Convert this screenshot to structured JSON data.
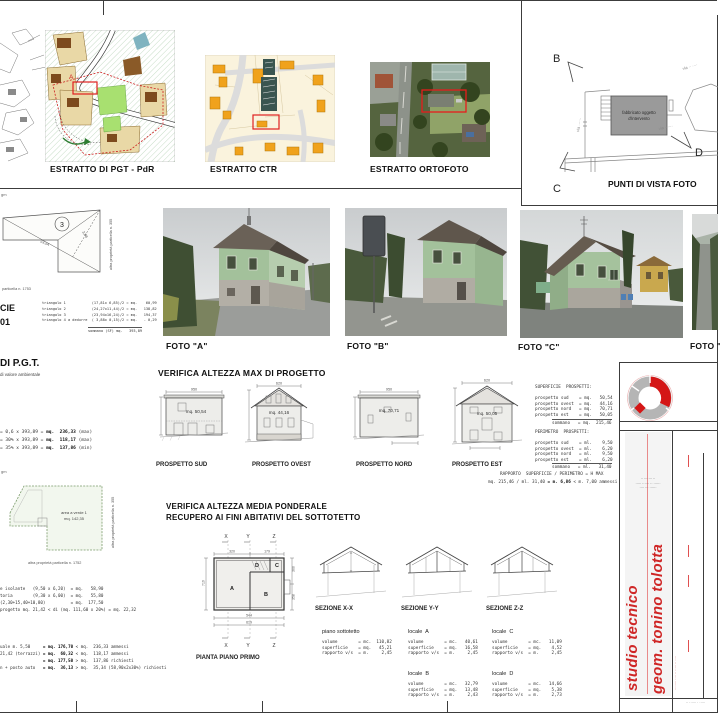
{
  "maps": {
    "pgt_label": "ESTRATTO DI PGT - PdR",
    "pgt_marker": "A",
    "ctr_label": "ESTRATTO CTR",
    "orto_label": "ESTRATTO ORTOFOTO"
  },
  "viewpoints": {
    "title": "PUNTI DI VISTA FOTO",
    "b": "B",
    "c": "C",
    "d": "D",
    "building_line1": "fabbricato oggetto",
    "building_line2": "d'intervento",
    "street_left": "via ······",
    "street_top": "via ·· ····",
    "street_d": "via ······"
  },
  "photos": {
    "a": "FOTO \"A\"",
    "b": "FOTO \"B\"",
    "c": "FOTO \"C\"",
    "d": "FOTO \"D\""
  },
  "survey": {
    "frag_top": "gm",
    "frag_mid": "gm",
    "parcel_no": "3",
    "dim_diag": "23,94",
    "dim_diag2": "3,88",
    "note_right": "altra proprietà particella n. 355",
    "note_bottom": "particella n. 1753",
    "heading_frag1": "CIE",
    "heading_frag2": "01",
    "triangles": "triangolo 1            (17,81x 6,85)/2 = mq.    60,99\ntriangolo 2            (24,27x11,44)/2 = mq.   138,82\ntriangolo 3            (23,94x16,24)/2 = mq.   194,37\ntriangolo 4 a dedurre  ( 3,88x 0,15)/2 = mq.   - 0,29",
    "triangles_total": "sommano (SF) mq.   393,89",
    "pgt_heading": "DI P.G.T.",
    "pgt_sub": "di valore ambientale",
    "pgt_rows": [
      {
        "calc": "= 0,6 x 393,89 =",
        "value": "mq.  236,33",
        "note": "(max)"
      },
      {
        "calc": "= 30% x 393,89 =",
        "value": "mq.  118,17",
        "note": "(max)"
      },
      {
        "calc": "= 35% x 393,89 =",
        "value": "mq.  137,86",
        "note": "(min)"
      }
    ],
    "verde_line1": "area a verde 1",
    "verde_line2": "mq. 142,35",
    "note_right2": "altra proprietà particella n. 355",
    "note_bottom2": "altra proprietà particella n. 1752",
    "calcs": "e isolante   (9,50 x 6,20)  = mq.   58,90\ntoria        (9,30 x 6,00)  = mq.   55,80\n(2,30+15,40+10,80)          = mq.  177,50\nprogetto mq. 21,42 < di (mq. 111,60 x 20%) = mq. 22,32",
    "summary_rows": [
      {
        "lead": "uale m. 5,50     ",
        "value": "= mq. 176,70",
        "rest": " < mq.  236,33 ammessi"
      },
      {
        "lead": "21,42 (terrazzi) ",
        "value": "= mq.  60,32",
        "rest": " < mq.  118,17 ammessi"
      },
      {
        "lead": "                 ",
        "value": "= mq. 177,50",
        "rest": " > mq.  137,86 richiesti"
      },
      {
        "lead": "n + posto auto   ",
        "value": "= mq.  36,13",
        "rest": " > mq.  35,34 (58,90x2x30%) richiesti"
      }
    ]
  },
  "verifica_max": {
    "title": "VERIFICA ALTEZZA MAX DI PROGETTO",
    "prospetti": [
      {
        "label": "PROSPETTO SUD",
        "area": "mq. 50,54",
        "dim": "950"
      },
      {
        "label": "PROSPETTO OVEST",
        "area": "mq. 44,16",
        "dim": "620"
      },
      {
        "label": "PROSPETTO NORD",
        "area": "mq. 70,71",
        "dim": "950"
      },
      {
        "label": "PROSPETTO EST",
        "area": "mq. 50,05",
        "dim": "620"
      }
    ],
    "sup_table": "SUPERFICIE  PROSPETTI:\n\nprospetto sud    = mq.   50,54\nprospetto ovest  = mq.   44,16\nprospetto nord   = mq.   70,71\nprospetto est    = mq.   50,05",
    "sup_total": "sommano   = mq.  215,46",
    "per_table": "PERIMETRO  PROSPETTI:\n\nprospetto sud    = ml.    9,50\nprospetto ovest  = ml.    6,20\nprospetto nord   = ml.    9,50\nprospetto est    = ml.    6,20",
    "per_total": "sommano   = ml.   31,40",
    "ratio_title": "RAPPORTO  SUPERFICIE / PERIMETRO = H MAX",
    "ratio_calc": "mq. 215,46 / ml. 31,40 ",
    "ratio_value": "= m. 6,86 ",
    "ratio_note": "< m. 7,00 ammessi"
  },
  "verifica_media": {
    "title1": "VERIFICA ALTEZZA MEDIA PONDERALE",
    "title2": "RECUPERO AI FINI ABITATIVI DEL SOTTOTETTO",
    "plan_label": "PIANTA PIANO PRIMO",
    "axes": [
      "X",
      "Y",
      "Z"
    ],
    "rooms": [
      "A",
      "B",
      "C",
      "D"
    ],
    "dims": {
      "top1": "320",
      "top2": "179",
      "bottom1": "544",
      "bottom2": "619",
      "left": "719",
      "right1": "300",
      "right2": "358"
    },
    "sections": [
      "SEZIONE X-X",
      "SEZIONE Y-Y",
      "SEZIONE Z-Z"
    ],
    "tables": {
      "sottotetto": {
        "title": "piano sottotetto",
        "rows": "volume        = mc.  110,82\nsuperficie    = mq.   45,21\nrapporto v/s  = m.     2,45"
      },
      "a": {
        "title": "locale  A",
        "rows": "volume        = mc.   40,61\nsuperficie    = mq.   16,58\nrapporto v/s  = m.     2,45"
      },
      "b": {
        "title": "locale  B",
        "rows": "volume        = mc.   32,79\nsuperficie    = mq.   13,48\nrapporto v/s  = m.     2,43"
      },
      "c": {
        "title": "locale  C",
        "rows": "volume        = mc.   11,09\nsuperficie    = mq.    4,52\nrapporto v/s  = m.     2,45"
      },
      "d": {
        "title": "locale  D",
        "rows": "volume        = mc.   14,66\nsuperficie    = mq.    5,38\nrapporto v/s  = m.     2,73"
      }
    }
  },
  "titleblock": {
    "studio_line1": "studio tecnico",
    "studio_line2": "geom. tonino tolotta",
    "address": "·· ······· ··\n····· ······ ·· ······\n···· ··· ······",
    "side_note": "········ ···· ·· ····· ·· ····",
    "bottom_note": "·· ······ · ·····"
  },
  "colors": {
    "accent_red": "#cf2626",
    "house_green": "#a3c19b",
    "zone_orange": "#f0a21c"
  }
}
